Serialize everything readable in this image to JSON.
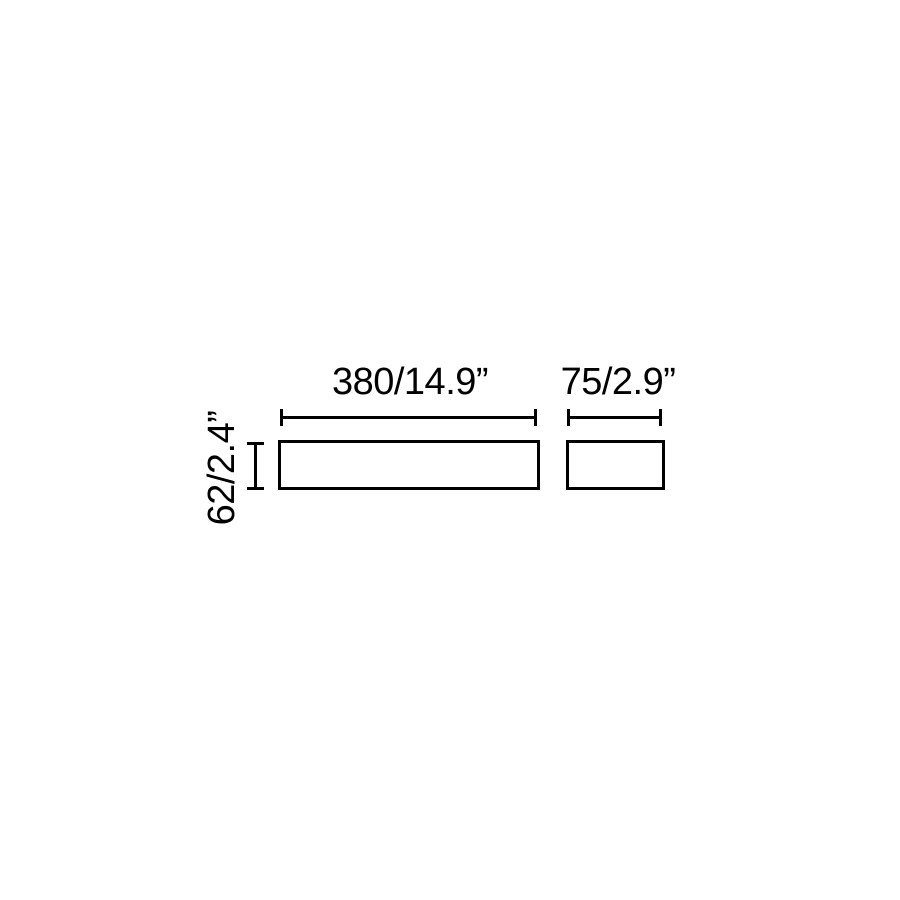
{
  "diagram": {
    "type": "technical-dimension-drawing",
    "background_color": "#ffffff",
    "line_color": "#000000",
    "views": {
      "front": {
        "width_label": "380/14.9”",
        "height_label": "62/2.4”"
      },
      "side": {
        "width_label": "75/2.9”"
      }
    }
  }
}
